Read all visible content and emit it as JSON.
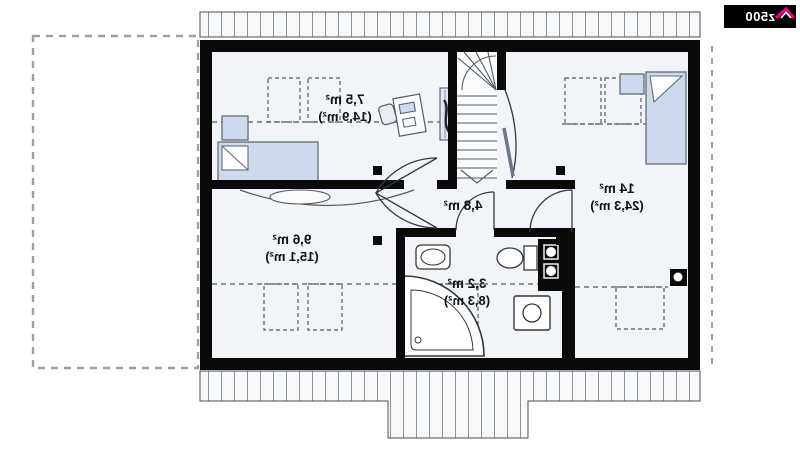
{
  "logo": {
    "text": "z500",
    "bg": "#000000",
    "accent": "#e5007d"
  },
  "rooms": [
    {
      "name": "bedroom-upper-left",
      "area": "7,5 m²",
      "total": "(14,9 m²)"
    },
    {
      "name": "bedroom-lower-left",
      "area": "9,6 m²",
      "total": "(15,1 m²)"
    },
    {
      "name": "hall",
      "area": "4,8 m²",
      "total": ""
    },
    {
      "name": "bathroom",
      "area": "3,2 m²",
      "total": "(8,3 m²)"
    },
    {
      "name": "bedroom-right",
      "area": "14 m²",
      "total": "(24,3 m²)"
    }
  ],
  "colors": {
    "wall": "#0a0a0a",
    "floor": "#f1f4f9",
    "furniture": "#ccdaed",
    "hatch_fill": "#f7f9fb",
    "dash": "#9aa0a6",
    "accent": "#e5007d"
  }
}
